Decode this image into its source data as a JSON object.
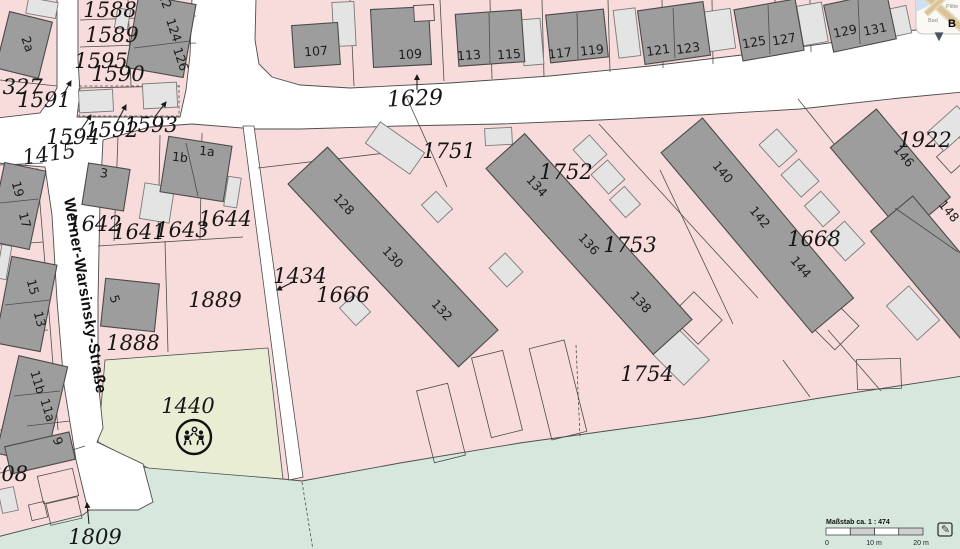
{
  "colors": {
    "parcel_pink": "#f8dbdb",
    "street_white": "#ffffff",
    "field_green": "#d6e8dd",
    "playground_green": "#e9edd3",
    "building_dark": "#9d9d9d",
    "building_light": "#e4e4e4",
    "boundary_line": "#4d4d4d"
  },
  "street": {
    "name": "Werner-Warsinsky-Straße"
  },
  "labels": {
    "p1588": "1588",
    "p1589": "1589",
    "p1595": "1595",
    "p1590": "1590",
    "p1591": "1591",
    "p1327": "1327",
    "p1594": "1594",
    "p1592": "1592",
    "p1593": "1593",
    "p1415": "1415",
    "p1629": "1629",
    "p1642": "1642",
    "p1641": "1641",
    "p1643": "1643",
    "p1644": "1644",
    "p1889": "1889",
    "p1888": "1888",
    "p1434": "1434",
    "p1666": "1666",
    "p1751": "1751",
    "p1752": "1752",
    "p1753": "1753",
    "p1754": "1754",
    "p1668": "1668",
    "p1922": "1922",
    "p1440": "1440",
    "p1809": "1809",
    "p808": "808"
  },
  "houses": {
    "h2a": "2a",
    "h122": "122",
    "h124": "124",
    "h126": "126",
    "h107": "107",
    "h109": "109",
    "h113": "113",
    "h115": "115",
    "h117": "117",
    "h119": "119",
    "h121": "121",
    "h123": "123",
    "h125": "125",
    "h127": "127",
    "h129": "129",
    "h131": "131",
    "h1b": "1b",
    "h1a": "1a",
    "h3": "3",
    "h5": "5",
    "h19": "19",
    "h17": "17",
    "h15": "15",
    "h13": "13",
    "h11b": "11b",
    "h11a": "11a",
    "h9": "9",
    "h128": "128",
    "h130": "130",
    "h132": "132",
    "h134": "134",
    "h136": "136",
    "h138": "138",
    "h140": "140",
    "h142": "142",
    "h144": "144",
    "h146": "146",
    "h148": "148"
  },
  "scalebar": {
    "title": "Maßstab ca. 1 : 474",
    "tick0": "0",
    "tick10": "10 m",
    "tick20": "20 m"
  },
  "inset": {
    "place1": "Plitte",
    "place2": "Bad",
    "place3": "B"
  },
  "icons": {
    "edit": "✎",
    "chevron_down": "▾"
  }
}
